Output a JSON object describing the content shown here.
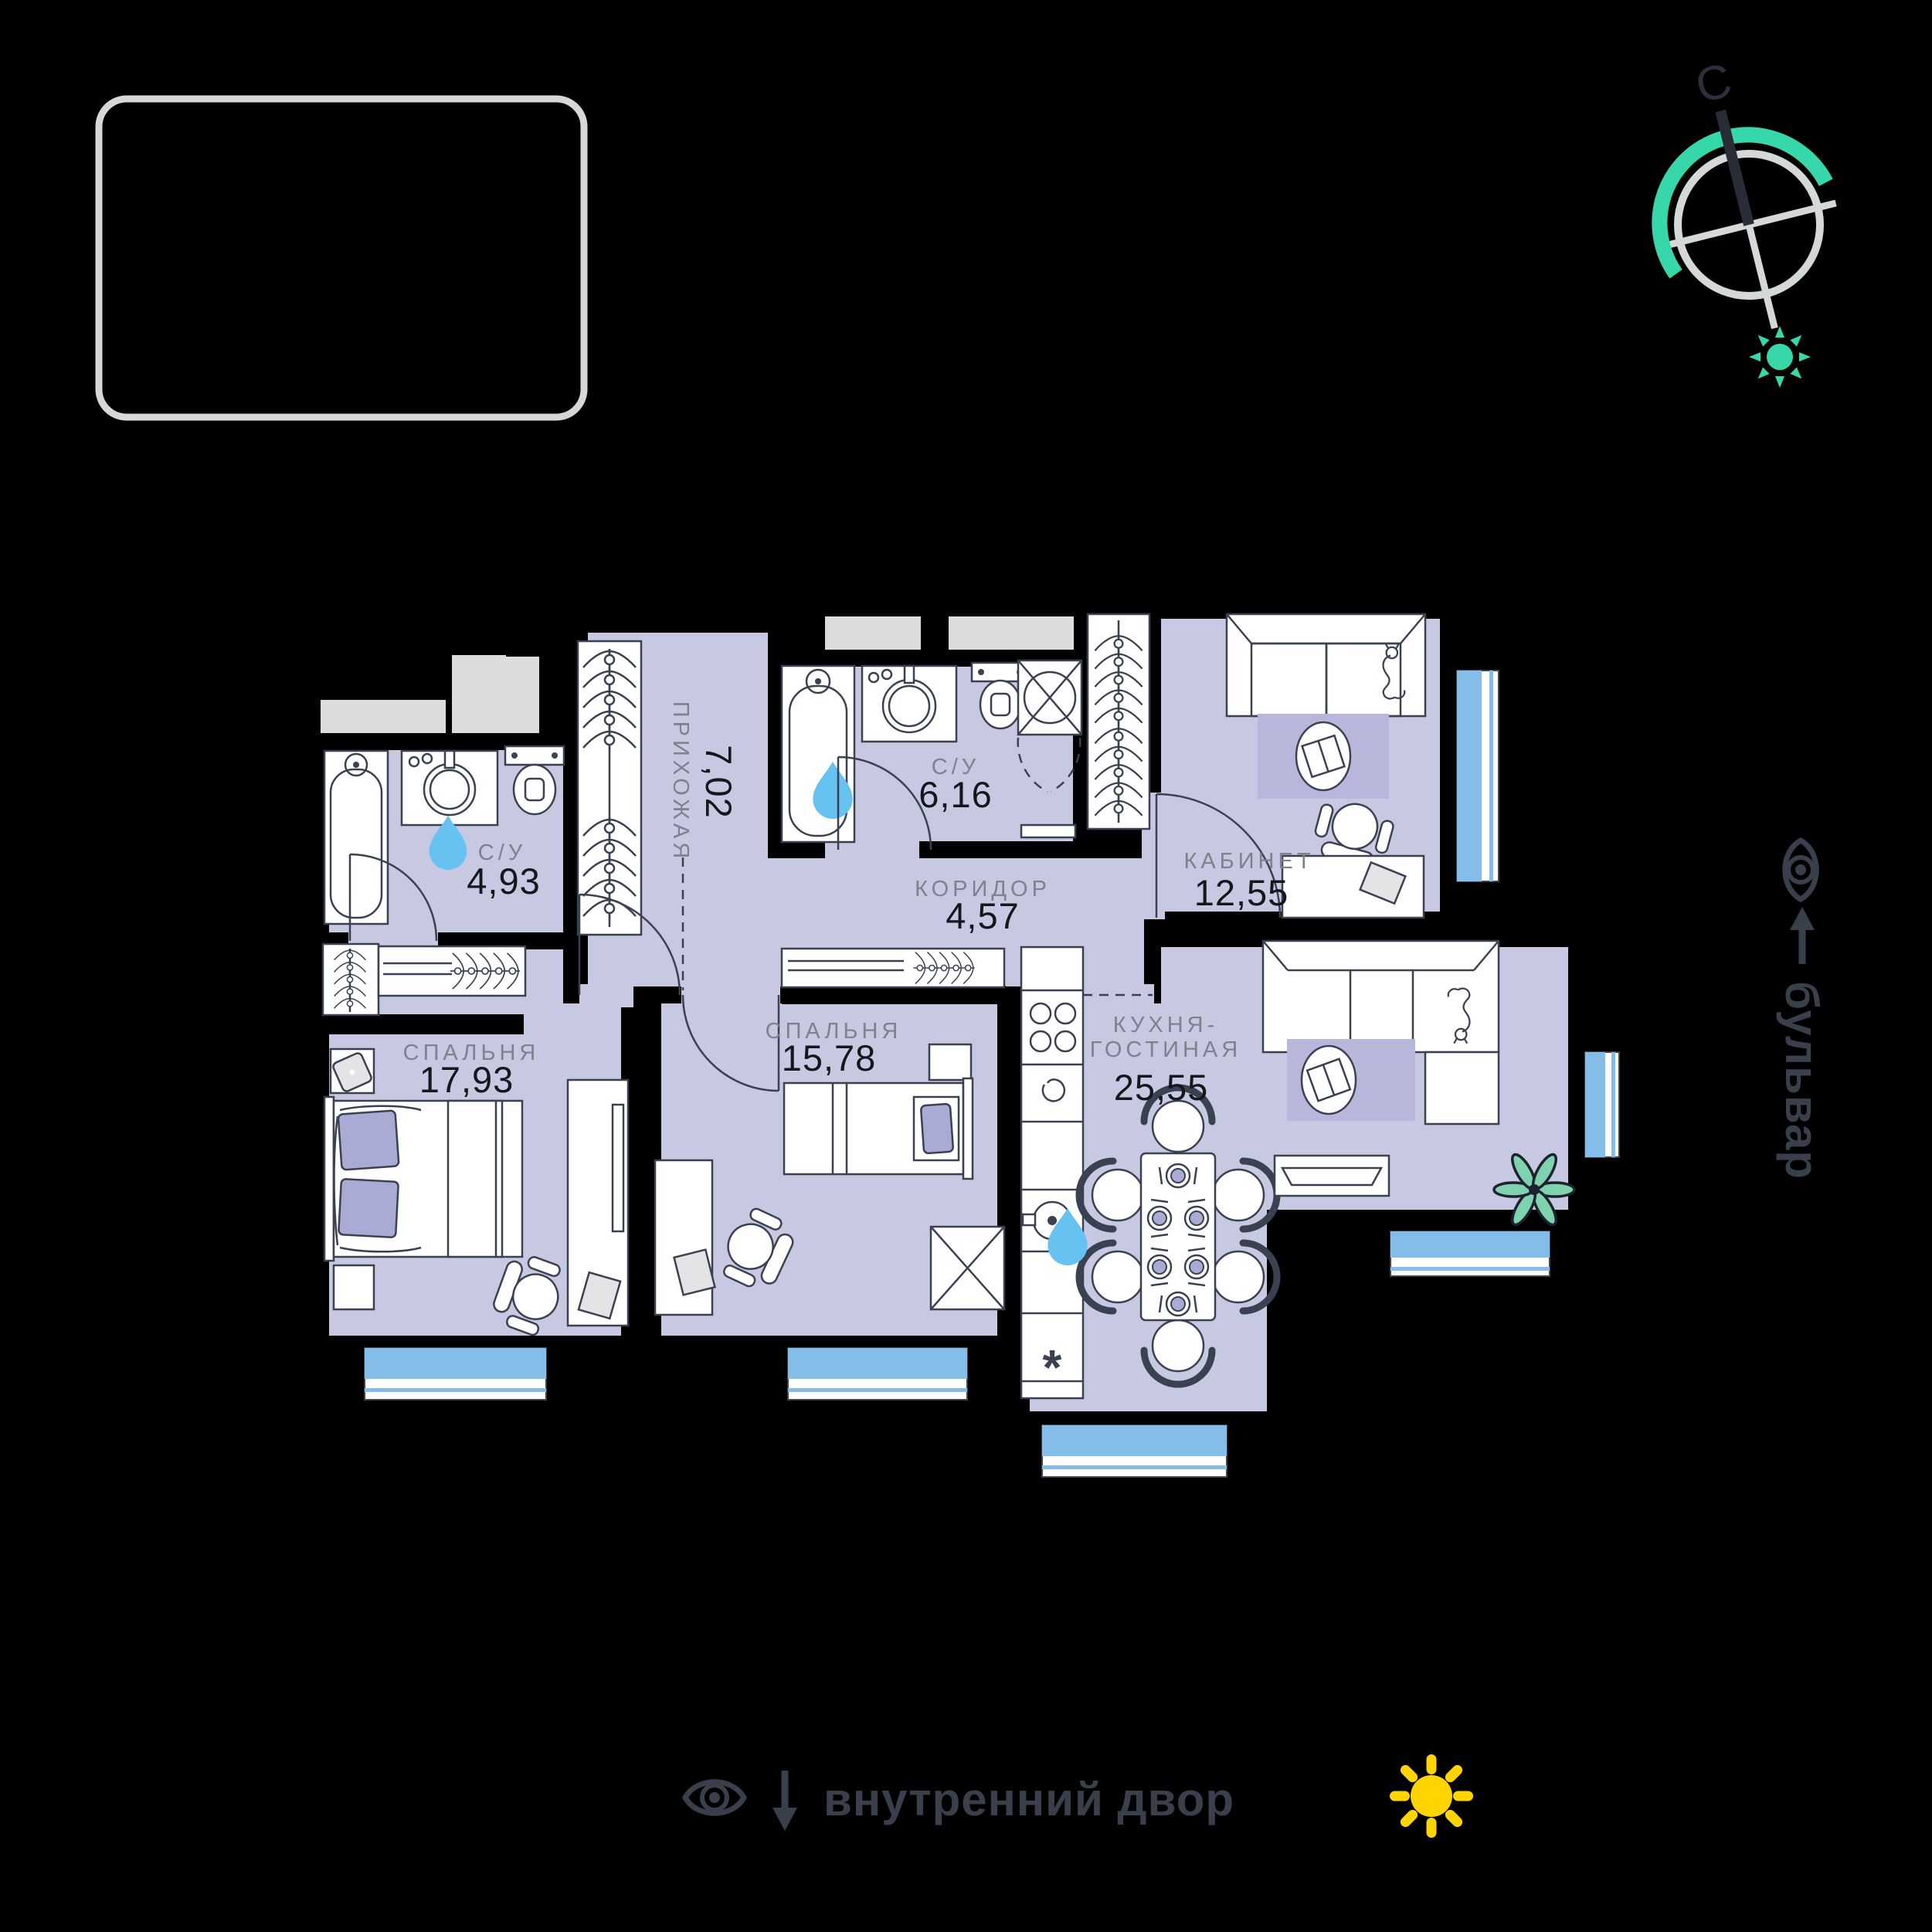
{
  "compass": {
    "north": "С"
  },
  "streets": {
    "right": "бульвар",
    "bottom": "внутренний двор"
  },
  "rooms": [
    {
      "key": "hallway",
      "name": "ПРИХОЖАЯ",
      "area": "7,02"
    },
    {
      "key": "bathroom-ensuite",
      "name": "С/У",
      "area": "4,93"
    },
    {
      "key": "bathroom-main",
      "name": "С/У",
      "area": "6,16"
    },
    {
      "key": "corridor",
      "name": "КОРИДОР",
      "area": "4,57"
    },
    {
      "key": "office",
      "name": "КАБИНЕТ",
      "area": "12,55"
    },
    {
      "key": "bedroom-1",
      "name": "СПАЛЬНЯ",
      "area": "17,93"
    },
    {
      "key": "bedroom-2",
      "name": "СПАЛЬНЯ",
      "area": "15,78"
    },
    {
      "key": "kitchen-living",
      "name_line1": "КУХНЯ-",
      "name_line2": "ГОСТИНАЯ",
      "area": "25,55"
    }
  ],
  "symbols": {
    "dishwasher": "*"
  },
  "colors": {
    "background": "#000000",
    "room_fill": "#c7c8e2",
    "rug_fill": "#b6b7db",
    "pillow_fill": "#a9abd5",
    "window_blue": "#85bde9",
    "accent_teal": "#35d7ab",
    "sun_yellow": "#ffd400",
    "water_drop": "#67c1f1",
    "outline_dark": "#3a4150",
    "label_gray": "#7d828b",
    "number_dark": "#17171b",
    "icon_slate": "#39404c",
    "frame_gray": "#d4d8d9"
  }
}
